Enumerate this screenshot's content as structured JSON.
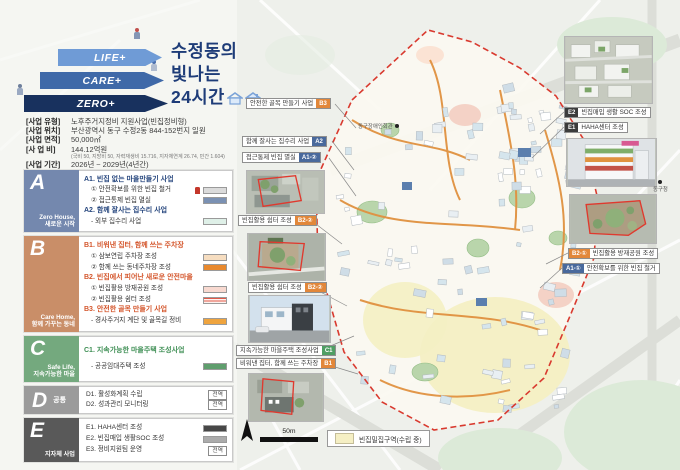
{
  "colors": {
    "accent_navy": "#1e3c78",
    "section_a": "#7488ae",
    "section_b": "#c98e68",
    "section_c": "#74a97e",
    "section_d": "#9b9b9b",
    "section_e": "#595959",
    "badge_a": "#49699c",
    "badge_b": "#e2873a",
    "badge_c": "#4f9e63",
    "badge_e": "#3c3c3c",
    "boundary_red": "#d93a2f",
    "legend_yellow": "#f5efc4"
  },
  "header": {
    "slogan_arrows": [
      "LIFE+",
      "CARE+",
      "ZERO+"
    ],
    "title_line1": "수정동의",
    "title_line2": "빛나는",
    "title_line3": "24시간"
  },
  "info": {
    "rows": [
      {
        "label": "[사업 유형]",
        "value": "노후주거지정비 지원사업(빈집정비형)"
      },
      {
        "label": "[사업 위치]",
        "value": "부산광역시 동구 수정2동 844-152번지 일원"
      },
      {
        "label": "[사업 면적]",
        "value": "50,000㎡"
      },
      {
        "label": "[사 업 비]",
        "value": "144.12억원",
        "note": "(국비 50, 지방비 50, 자력재생비 15.716, 지자체연계 26.74, 민간 1.604)"
      },
      {
        "label": "[사업 기간]",
        "value": "2026년 ~ 2029년(4년간)"
      }
    ]
  },
  "sections": [
    {
      "letter": "A",
      "subtitle_en": "Zero House,",
      "subtitle_ko": "새로운 시작",
      "groups": [
        {
          "title": "A1. 빈집 없는 마을만들기 사업",
          "items": [
            {
              "text": "① 안전확보를 위한 빈집 철거",
              "swatch": "#dbdbdb"
            },
            {
              "text": "② 접근통제 빈집 멸실",
              "swatch": "#7b91b3"
            }
          ]
        },
        {
          "title": "A2. 함께 잘사는 집수리 사업",
          "items": [
            {
              "text": "- 외부 집수리 사업",
              "swatch": "#dff0e8"
            }
          ]
        }
      ]
    },
    {
      "letter": "B",
      "subtitle_en": "Care Home,",
      "subtitle_ko": "함께 가꾸는 동네",
      "groups": [
        {
          "title": "B1. 비워낸 집터, 함께 쓰는 주차장",
          "items": [
            {
              "text": "① 삼보연립 주차장 조성",
              "swatch": "#f6ddc0"
            },
            {
              "text": "② 함께 쓰는 동네주차장 조성",
              "swatch": "#e8892e"
            }
          ]
        },
        {
          "title": "B2. 빈집에서 피어난 새로운 안전마을",
          "items": [
            {
              "text": "① 빈집활용 방재공원 조성",
              "swatch": "#f8d9d0"
            },
            {
              "text": "② 빈집활용 쉼터 조성",
              "swatch": "hatch"
            }
          ]
        },
        {
          "title": "B3. 안전한 골목 만들기 사업",
          "items": [
            {
              "text": "- 경사주거지 계단 및 골목길 정비",
              "swatch": "#efa43e"
            }
          ]
        }
      ]
    },
    {
      "letter": "C",
      "subtitle_en": "Safe Life,",
      "subtitle_ko": "지속가능한 마을",
      "groups": [
        {
          "title": "C1. 지속가능한 마을주택 조성사업",
          "items": [
            {
              "text": "- 공공임대주택 조성",
              "swatch": "#5f9e6d"
            }
          ]
        }
      ]
    },
    {
      "letter": "D",
      "subtitle_ko": "공통",
      "groups": [
        {
          "title": "",
          "items": [
            {
              "text": "D1. 활성화계획 수립",
              "badge": "전역"
            },
            {
              "text": "D2. 성과관리 모니터링",
              "badge": "전역"
            }
          ]
        }
      ]
    },
    {
      "letter": "E",
      "subtitle_ko": "지자체 사업",
      "groups": [
        {
          "title": "",
          "items": [
            {
              "text": "E1. HAHA센터 조성",
              "swatch": "#474747"
            },
            {
              "text": "E2. 빈집매입 생활SOC 조성",
              "swatch": "#ababab"
            },
            {
              "text": "E3. 정비지원팀 운영",
              "badge": "전역"
            }
          ]
        }
      ]
    }
  ],
  "map": {
    "labels_left": [
      {
        "text": "안전한 골목 만들기 사업",
        "badge": "B3"
      },
      {
        "text": "함께 잘사는 집수리 사업",
        "badge": "A2"
      },
      {
        "text": "접근통제 빈집 멸실",
        "badge": "A1-②"
      },
      {
        "text": "빈집활용 쉼터 조성",
        "badge": "B2-②"
      },
      {
        "text": "빈집활용 쉼터 조성",
        "badge": "B2-②"
      },
      {
        "text": "지속가능한 마을주택 조성사업",
        "badge": "C1"
      },
      {
        "text": "비워낸 집터, 함께 쓰는 주차장",
        "badge": "B1"
      }
    ],
    "labels_right": [
      {
        "badge": "E2",
        "text": "빈집매입 생활 SOC 조성"
      },
      {
        "badge": "E1",
        "text": "HAHA센터 조성"
      },
      {
        "badge": "B2-①",
        "text": "빈집활용 방재공원 조성"
      },
      {
        "badge": "A1-①",
        "text": "안전확보를 위한 빈집 철거"
      }
    ],
    "pois": [
      {
        "name": "동구장애인회관"
      },
      {
        "name": "동구청"
      }
    ],
    "scale_label": "50m",
    "legend_label": "빈집밀집구역(수립 중)"
  }
}
